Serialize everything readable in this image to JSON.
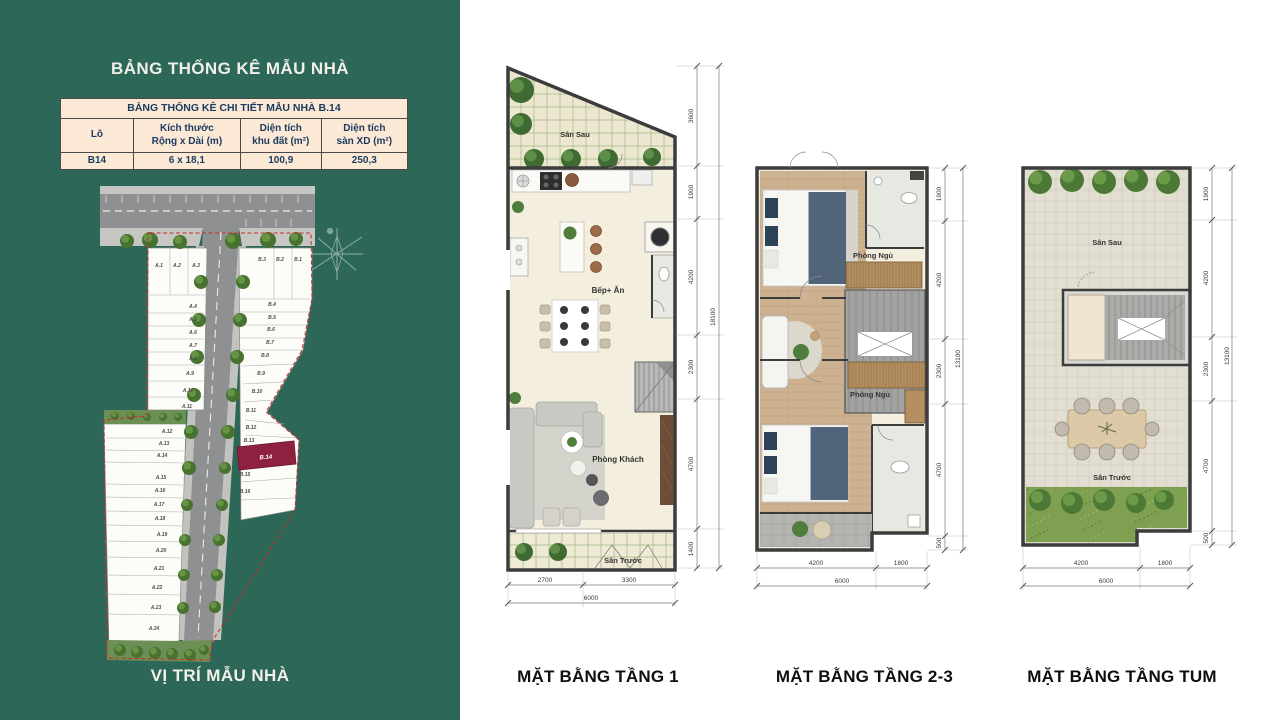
{
  "colors": {
    "sidebar_bg": "#2D6757",
    "table_bg": "#FBE9D6",
    "table_text": "#1B3A5F",
    "highlight_lot_color": "#8E2040",
    "caption_text": "#0F0F0F"
  },
  "sidebar": {
    "title": "BẢNG THỐNG KÊ MẪU NHÀ",
    "caption": "VỊ TRÍ MẪU NHÀ",
    "table": {
      "title": "BẢNG THỐNG KÊ CHI TIẾT MẪU NHÀ B.14",
      "columns": [
        {
          "line1": "Lô",
          "line2": ""
        },
        {
          "line1": "Kích thước",
          "line2": "Rộng x Dài (m)"
        },
        {
          "line1": "Diện tích",
          "line2": "khu đất (m²)"
        },
        {
          "line1": "Diện tích",
          "line2": "sàn XD (m²)"
        }
      ],
      "row": {
        "lot": "B14",
        "size": "6 x 18,1",
        "land_area": "100,9",
        "floor_area": "250,3"
      }
    },
    "site_plan": {
      "highlighted_lot": "B.14",
      "lots_a": [
        {
          "label": "A.1",
          "x": 159,
          "y": 267
        },
        {
          "label": "A.2",
          "x": 177,
          "y": 267
        },
        {
          "label": "A.3",
          "x": 196,
          "y": 267
        },
        {
          "label": "A.4",
          "x": 193,
          "y": 308
        },
        {
          "label": "A.5",
          "x": 193,
          "y": 321
        },
        {
          "label": "A.6",
          "x": 193,
          "y": 334
        },
        {
          "label": "A.7",
          "x": 193,
          "y": 347
        },
        {
          "label": "A.8",
          "x": 193,
          "y": 360
        },
        {
          "label": "A.9",
          "x": 190,
          "y": 375
        },
        {
          "label": "A.10",
          "x": 188,
          "y": 392
        },
        {
          "label": "A.11",
          "x": 187,
          "y": 408
        },
        {
          "label": "A.12",
          "x": 167,
          "y": 433
        },
        {
          "label": "A.13",
          "x": 164,
          "y": 445
        },
        {
          "label": "A.14",
          "x": 162,
          "y": 457
        },
        {
          "label": "A.15",
          "x": 161,
          "y": 479
        },
        {
          "label": "A.16",
          "x": 160,
          "y": 492
        },
        {
          "label": "A.17",
          "x": 159,
          "y": 506
        },
        {
          "label": "A.18",
          "x": 160,
          "y": 520
        },
        {
          "label": "A.19",
          "x": 162,
          "y": 536
        },
        {
          "label": "A.20",
          "x": 161,
          "y": 552
        },
        {
          "label": "A.21",
          "x": 159,
          "y": 570
        },
        {
          "label": "A.22",
          "x": 157,
          "y": 589
        },
        {
          "label": "A.23",
          "x": 156,
          "y": 609
        },
        {
          "label": "A.24",
          "x": 154,
          "y": 630
        }
      ],
      "lots_b": [
        {
          "label": "B.3",
          "x": 262,
          "y": 261
        },
        {
          "label": "B.2",
          "x": 280,
          "y": 261
        },
        {
          "label": "B.1",
          "x": 298,
          "y": 261
        },
        {
          "label": "B.4",
          "x": 272,
          "y": 306
        },
        {
          "label": "B.5",
          "x": 272,
          "y": 319
        },
        {
          "label": "B.6",
          "x": 271,
          "y": 331
        },
        {
          "label": "B.7",
          "x": 270,
          "y": 344
        },
        {
          "label": "B.8",
          "x": 265,
          "y": 357
        },
        {
          "label": "B.9",
          "x": 261,
          "y": 375
        },
        {
          "label": "B.10",
          "x": 257,
          "y": 393
        },
        {
          "label": "B.11",
          "x": 251,
          "y": 412
        },
        {
          "label": "B.12",
          "x": 251,
          "y": 429
        },
        {
          "label": "B.13",
          "x": 249,
          "y": 442
        },
        {
          "label": "B.15",
          "x": 245,
          "y": 476
        },
        {
          "label": "B.16",
          "x": 245,
          "y": 493
        }
      ]
    }
  },
  "plans": [
    {
      "caption": "MẶT BẰNG TẦNG 1",
      "rooms": {
        "back_yard": "Sân Sau",
        "kitchen": "Bếp+ Ăn",
        "living": "Phòng Khách",
        "front_yard": "Sân Trước"
      },
      "dims_right": [
        "3600",
        "1900",
        "4200",
        "2300",
        "4700",
        "1400"
      ],
      "dims_right_total": "18100",
      "dims_bottom": [
        "2700",
        "3300"
      ],
      "dims_bottom_total": "6000"
    },
    {
      "caption": "MẶT BẰNG TẦNG 2-3",
      "rooms": {
        "bedroom1": "Phòng Ngủ",
        "bedroom2": "Phòng Ngủ"
      },
      "dims_right": [
        "1900",
        "4200",
        "2300",
        "4700",
        "500"
      ],
      "dims_right_total": "13100",
      "dims_bottom": [
        "4200",
        "1800"
      ],
      "dims_bottom_total": "6000"
    },
    {
      "caption": "MẶT BẰNG TẦNG TUM",
      "rooms": {
        "back_yard": "Sân Sau",
        "front_yard": "Sân Trước"
      },
      "dims_right": [
        "1900",
        "4200",
        "2300",
        "4700",
        "500"
      ],
      "dims_right_total": "13100",
      "dims_bottom": [
        "4200",
        "1800"
      ],
      "dims_bottom_total": "6000"
    }
  ]
}
